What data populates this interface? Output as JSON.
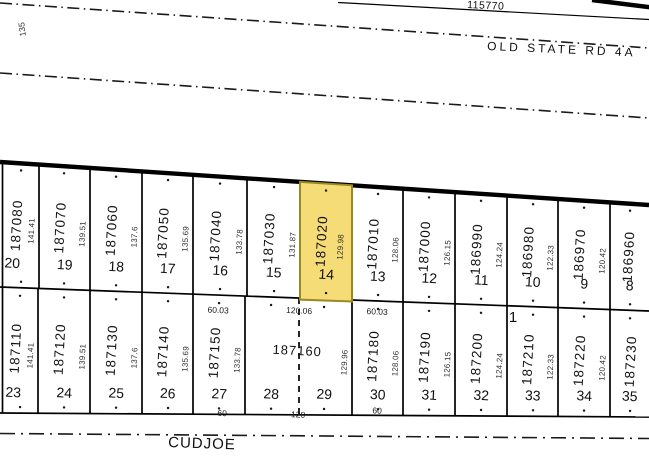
{
  "header": {
    "road_id_label": "115770",
    "road_name_top": "OLD STATE RD 4A",
    "road_name_bottom": "CUDJOE",
    "left_edge_dim": "135",
    "block_number": "1"
  },
  "selected_parcel": {
    "id": "187020",
    "lot": "14",
    "fill": "#F5DC76",
    "border": "#9A8820"
  },
  "row1": [
    {
      "parcel": "187080",
      "lot": "20",
      "dim": "141.41"
    },
    {
      "parcel": "187070",
      "lot": "19",
      "dim": "139.51"
    },
    {
      "parcel": "187060",
      "lot": "18",
      "dim": "137.6"
    },
    {
      "parcel": "187050",
      "lot": "17",
      "dim": "135.69"
    },
    {
      "parcel": "187040",
      "lot": "16",
      "dim": "133.78"
    },
    {
      "parcel": "187030",
      "lot": "15",
      "dim": "131.87"
    },
    {
      "parcel": "187020",
      "lot": "14",
      "dim": "129.98"
    },
    {
      "parcel": "187010",
      "lot": "13",
      "dim": "128.06"
    },
    {
      "parcel": "187000",
      "lot": "12",
      "dim": "126.15"
    },
    {
      "parcel": "186990",
      "lot": "11",
      "dim": "124.24"
    },
    {
      "parcel": "186980",
      "lot": "10",
      "dim": "122.33"
    },
    {
      "parcel": "186970",
      "lot": "9",
      "dim": "120.42"
    },
    {
      "parcel": "186960",
      "lot": "8"
    }
  ],
  "row2": [
    {
      "parcel": "187110",
      "lot": "23",
      "dim": "141.41"
    },
    {
      "parcel": "187120",
      "lot": "24",
      "dim": "139.51"
    },
    {
      "parcel": "187130",
      "lot": "25",
      "dim": "137.6"
    },
    {
      "parcel": "187140",
      "lot": "26",
      "dim": "135.69"
    },
    {
      "parcel": "187150",
      "lot": "27",
      "dim": "133.78"
    },
    {
      "parcel": "187160",
      "lot_a": "28",
      "lot_b": "29",
      "dim": "129.96"
    },
    {
      "parcel": "187180",
      "lot": "30",
      "dim": "128.06"
    },
    {
      "parcel": "187190",
      "lot": "31",
      "dim": "126.15"
    },
    {
      "parcel": "187200",
      "lot": "32",
      "dim": "124.24"
    },
    {
      "parcel": "187210",
      "lot": "33",
      "dim": "122.33"
    },
    {
      "parcel": "187220",
      "lot": "34",
      "dim": "120.42"
    },
    {
      "parcel": "187230",
      "lot": "35"
    }
  ],
  "divider_dims": {
    "left": "60.03",
    "center": "120.06",
    "right": "60.03"
  },
  "street_dims": {
    "left": "60",
    "center": "120",
    "right": "60"
  }
}
